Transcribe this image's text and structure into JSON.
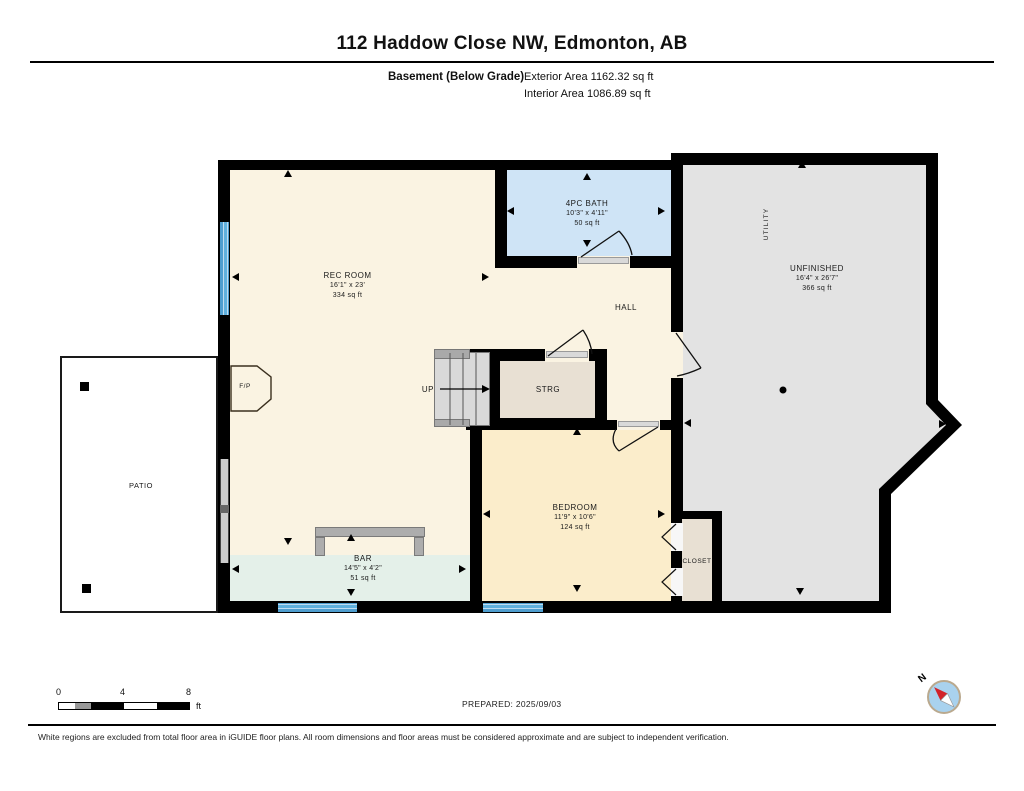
{
  "header": {
    "title": "112 Haddow Close NW, Edmonton, AB",
    "floor_label": "Basement (Below Grade)",
    "exterior_area": "Exterior Area 1162.32 sq ft",
    "interior_area": "Interior Area 1086.89 sq ft"
  },
  "rooms": {
    "rec_room": {
      "name": "REC ROOM",
      "dims": "16'1\" x 23'",
      "area": "334 sq ft"
    },
    "bath": {
      "name": "4PC BATH",
      "dims": "10'3\" x 4'11\"",
      "area": "50 sq ft"
    },
    "hall": {
      "name": "HALL"
    },
    "strg": {
      "name": "STRG"
    },
    "up": {
      "name": "UP"
    },
    "bedroom": {
      "name": "BEDROOM",
      "dims": "11'9\" x 10'6\"",
      "area": "124 sq ft"
    },
    "bar": {
      "name": "BAR",
      "dims": "14'5\" x 4'2\"",
      "area": "51 sq ft"
    },
    "closet": {
      "name": "CLOSET"
    },
    "unfinished": {
      "name": "UNFINISHED",
      "dims": "16'4\" x 26'7\"",
      "area": "366 sq ft"
    },
    "utility": {
      "name": "UTILITY"
    },
    "fireplace": {
      "name": "F/P"
    },
    "patio": {
      "name": "PATIO"
    }
  },
  "scale_bar": {
    "t0": "0",
    "t4": "4",
    "t8": "8",
    "unit": "ft"
  },
  "compass": {
    "north_label": "N"
  },
  "footer": {
    "prepared": "PREPARED: 2025/09/03",
    "disclaimer": "White regions are excluded from total floor area in iGUIDE floor plans. All room dimensions and floor areas must be considered approximate and are subject to independent verification."
  },
  "colors": {
    "wall": "#000000",
    "floor_main": "#FAF3E2",
    "floor_bath": "#CFE4F6",
    "floor_unfinished": "#E3E3E3",
    "floor_bedroom": "#FBEDCB",
    "floor_bar": "#E4F0E9",
    "floor_storage": "#E8E0D3",
    "window_blue": "#5BA7D6",
    "counter_gray": "#ADADAD",
    "compass_fill": "#A9D2EE",
    "compass_needle": "#D2232A"
  }
}
